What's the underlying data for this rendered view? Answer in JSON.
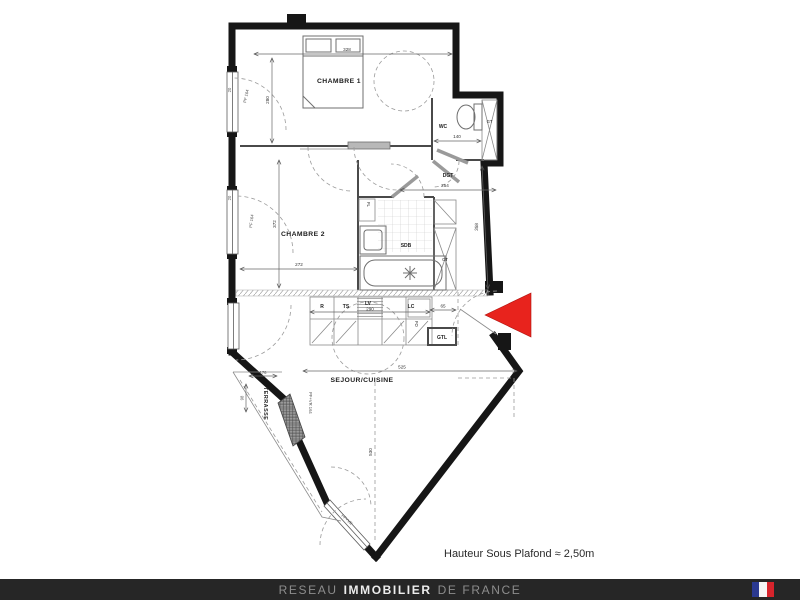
{
  "meta": {
    "note": "Hauteur Sous Plafond ≈ 2,50m"
  },
  "rooms": {
    "chambre1": "CHAMBRE 1",
    "chambre2": "CHAMBRE 2",
    "wc": "WC",
    "dgt": "DGT",
    "sdb": "SDB",
    "sejour": "SEJOUR/CUISINE",
    "terrasse": "TERRASSE"
  },
  "closets": {
    "gt_wc": "GT",
    "gt_sdb": "GT",
    "gtl": "GTL",
    "fl": "FL"
  },
  "kitchen": {
    "r": "R",
    "ts": "TS",
    "lv": "LV",
    "lc": "LC",
    "fo": "FO"
  },
  "dims": {
    "chambre1_w": "328",
    "chambre1_h": "280",
    "wc_w": "140",
    "dgt_w": "254",
    "hall_h": "358",
    "chambre2_w": "272",
    "chambre2_h": "372",
    "kitchen_w": "290",
    "entry_w": "65",
    "sejour_w": "525",
    "sejour_h": "530",
    "terrasse_w": "176",
    "terrasse_d": "98",
    "wall_t1": "20",
    "wall_t2": "20"
  },
  "windows": {
    "w1": "PF 164",
    "w2": "PF 164",
    "w3": "PF+VR 164",
    "w4": "PF+VR"
  },
  "footer": {
    "part1": "RESEAU",
    "part2": "IMMOBILIER",
    "part3": "DE FRANCE"
  },
  "colors": {
    "arrow": "#e8231d",
    "footer_bg": "#262626",
    "flag_blue": "#2b3990",
    "flag_white": "#f5f5f5",
    "flag_red": "#d6242c",
    "wall": "#161616"
  }
}
